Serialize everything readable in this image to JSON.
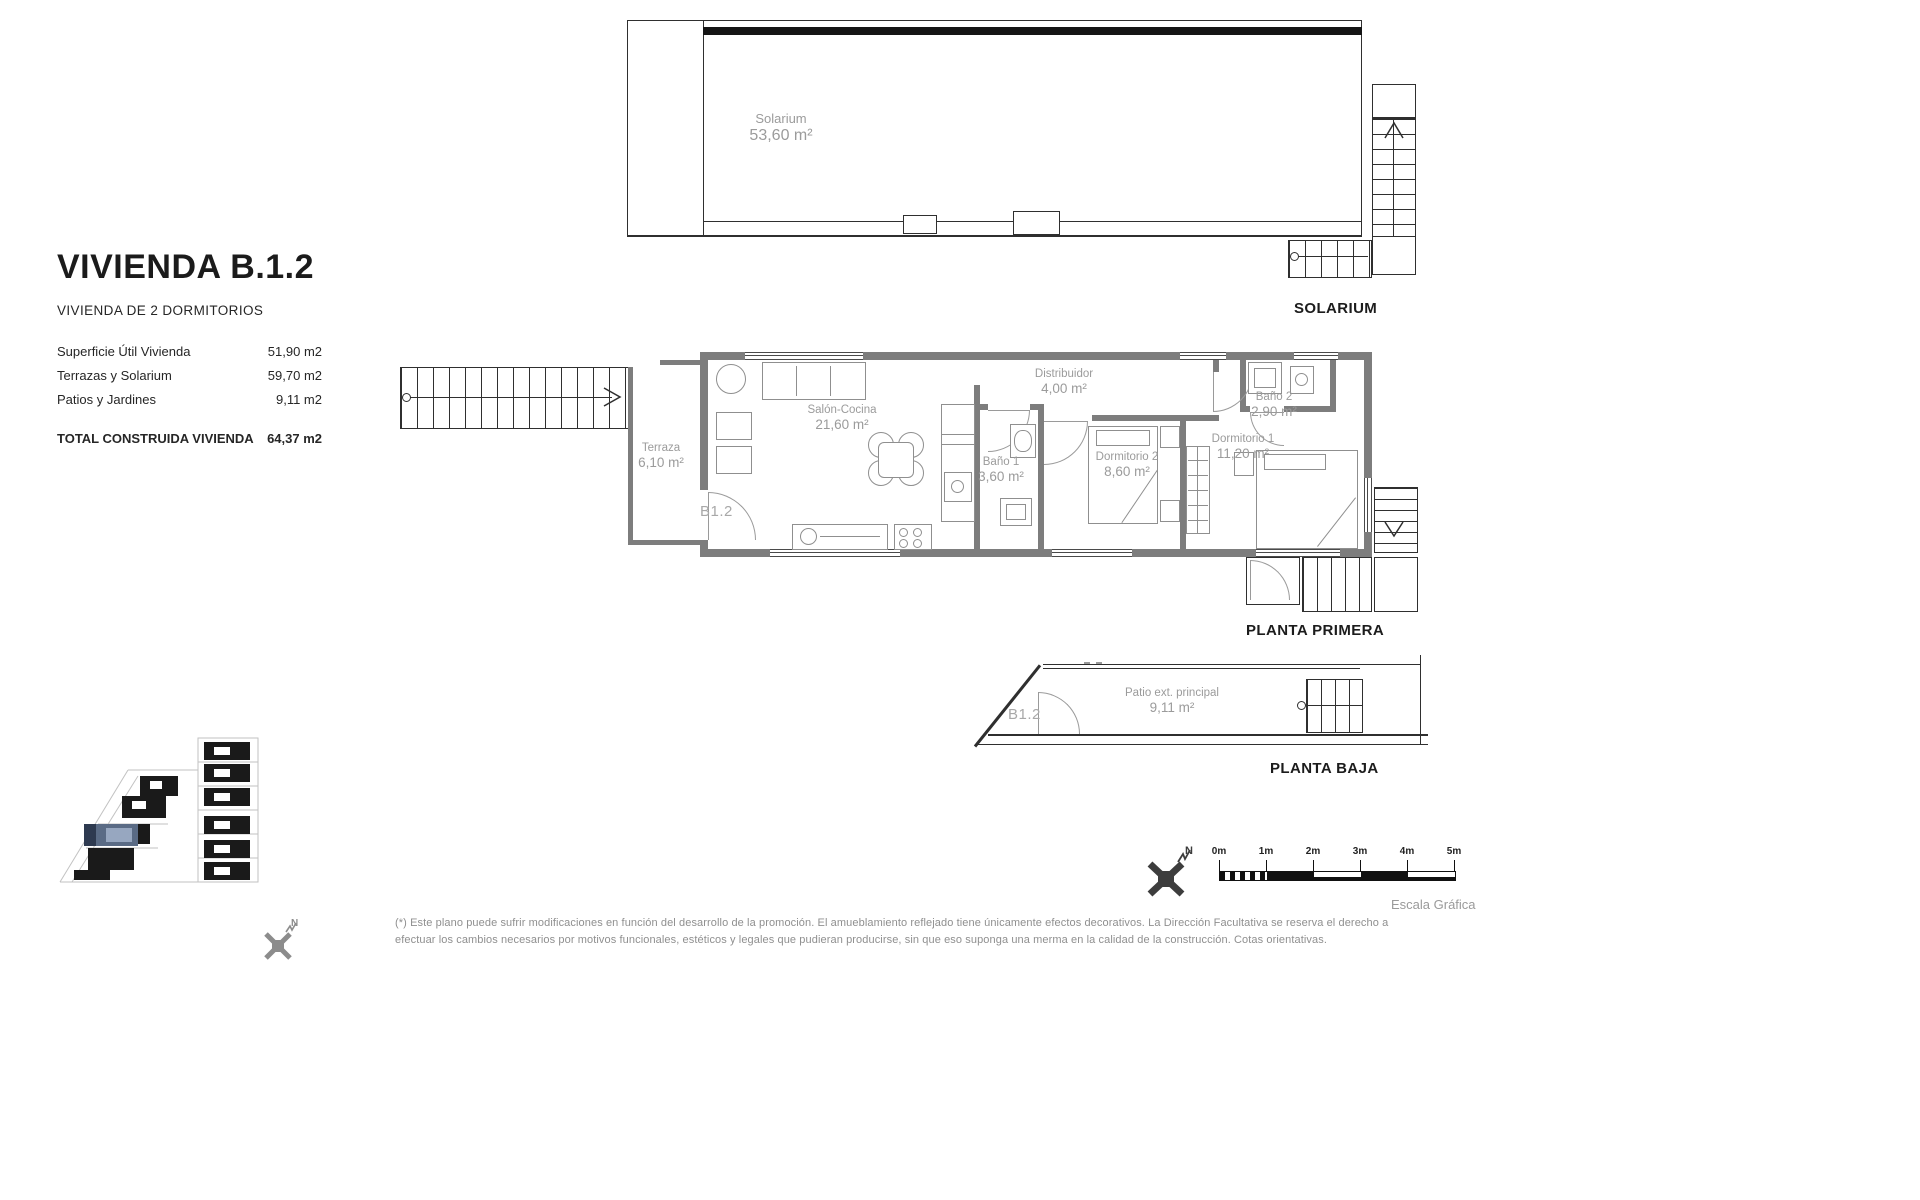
{
  "title_block": {
    "title": "VIVIENDA B.1.2",
    "subtitle": "VIVIENDA DE 2 DORMITORIOS",
    "rows": [
      {
        "label": "Superficie Útil Vivienda",
        "value": "51,90 m2"
      },
      {
        "label": "Terrazas y Solarium",
        "value": "59,70 m2"
      },
      {
        "label": "Patios y Jardines",
        "value": "9,11 m2"
      }
    ],
    "total": {
      "label": "TOTAL CONSTRUIDA VIVIENDA",
      "value": "64,37 m2"
    }
  },
  "plans": {
    "solarium": {
      "caption": "SOLARIUM",
      "room": {
        "name": "Solarium",
        "area": "53,60 m²"
      }
    },
    "planta_primera": {
      "caption": "PLANTA PRIMERA",
      "unit_label": "B1.2",
      "rooms": [
        {
          "name": "Terraza",
          "area": "6,10 m²"
        },
        {
          "name": "Salón-Cocina",
          "area": "21,60 m²"
        },
        {
          "name": "Distribuidor",
          "area": "4,00 m²"
        },
        {
          "name": "Baño 1",
          "area": "3,60 m²"
        },
        {
          "name": "Dormitorio 2",
          "area": "8,60 m²"
        },
        {
          "name": "Dormitorio 1",
          "area": "11,20 m²"
        },
        {
          "name": "Baño 2",
          "area": "2,90 m²"
        }
      ]
    },
    "planta_baja": {
      "caption": "PLANTA BAJA",
      "unit_label": "B1.2",
      "room": {
        "name": "Patio ext. principal",
        "area": "9,11 m²"
      }
    }
  },
  "scale_bar": {
    "ticks": [
      "0m",
      "1m",
      "2m",
      "3m",
      "4m",
      "5m"
    ],
    "caption": "Escala Gráfica"
  },
  "compass": {
    "north_label": "N"
  },
  "footnote": {
    "line1": "(*) Este plano puede sufrir modificaciones en función del desarrollo de la promoción. El amueblamiento reflejado tiene únicamente efectos decorativos. La Dirección Facultativa se reserva el derecho a",
    "line2": "efectuar los cambios necesarios por motivos funcionales, estéticos y legales que pudieran producirse, sin que eso suponga una merma en la calidad de la construcción. Cotas orientativas."
  },
  "colors": {
    "wall": "#7d7d7d",
    "line": "#2f2f2f",
    "label": "#9b9b9b",
    "highlight": "#5a6b85"
  }
}
